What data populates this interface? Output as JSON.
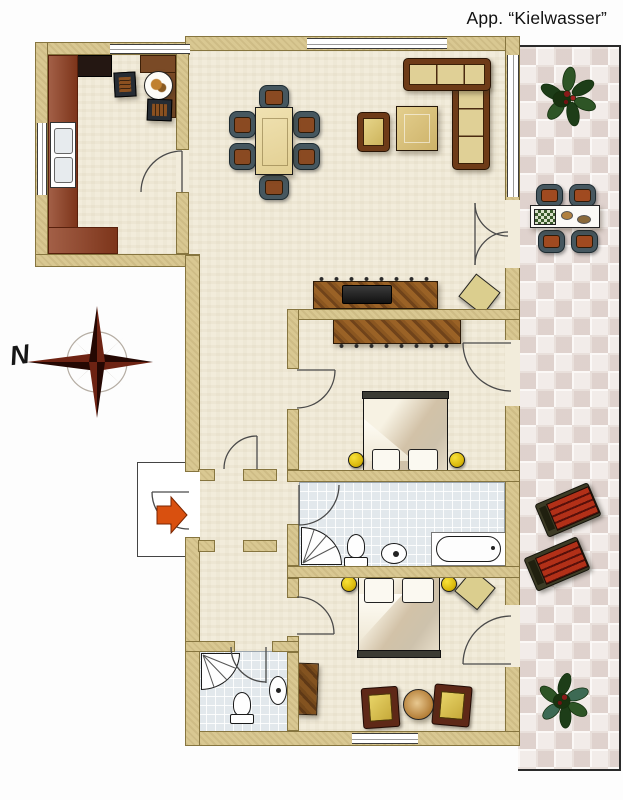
{
  "title": "App. “Kielwasser”",
  "compass": {
    "label": "N"
  },
  "colors": {
    "wall": "#d9c892",
    "floor": "#f2ecdb",
    "bathroom_tile": "#e2e8ec",
    "terrace_tile": "#eae0dc",
    "kitchen_counter": "#8e3c1e",
    "wood_furniture": "#7a4a1c",
    "sofa_frame": "#6e3b18",
    "cushion": "#e0d096",
    "nightstand_yellow": "#d9b70a",
    "lounger_red": "#b23018",
    "plant_green": "#2e5526",
    "entry_arrow_orange": "#d9500f",
    "compass_dark": "#3d0e06"
  },
  "rooms": [
    {
      "name": "kitchen"
    },
    {
      "name": "living-dining-room"
    },
    {
      "name": "hallway"
    },
    {
      "name": "bedroom-1"
    },
    {
      "name": "bathroom-1"
    },
    {
      "name": "bedroom-2"
    },
    {
      "name": "bathroom-2"
    },
    {
      "name": "terrace"
    }
  ],
  "furniture": [
    "kitchen-counter",
    "kitchen-sink",
    "kitchen-breakfast-table",
    "kitchen-chairs",
    "dining-table",
    "dining-chairs",
    "corner-sofa",
    "armchair",
    "coffee-table",
    "tv-sideboard",
    "wardrobes",
    "double-beds",
    "nightstands",
    "poufs",
    "bathtub",
    "showers",
    "toilets",
    "bidet",
    "washbasin",
    "terrace-table",
    "terrace-chairs",
    "sun-loungers",
    "plants",
    "entrance-arrow"
  ]
}
